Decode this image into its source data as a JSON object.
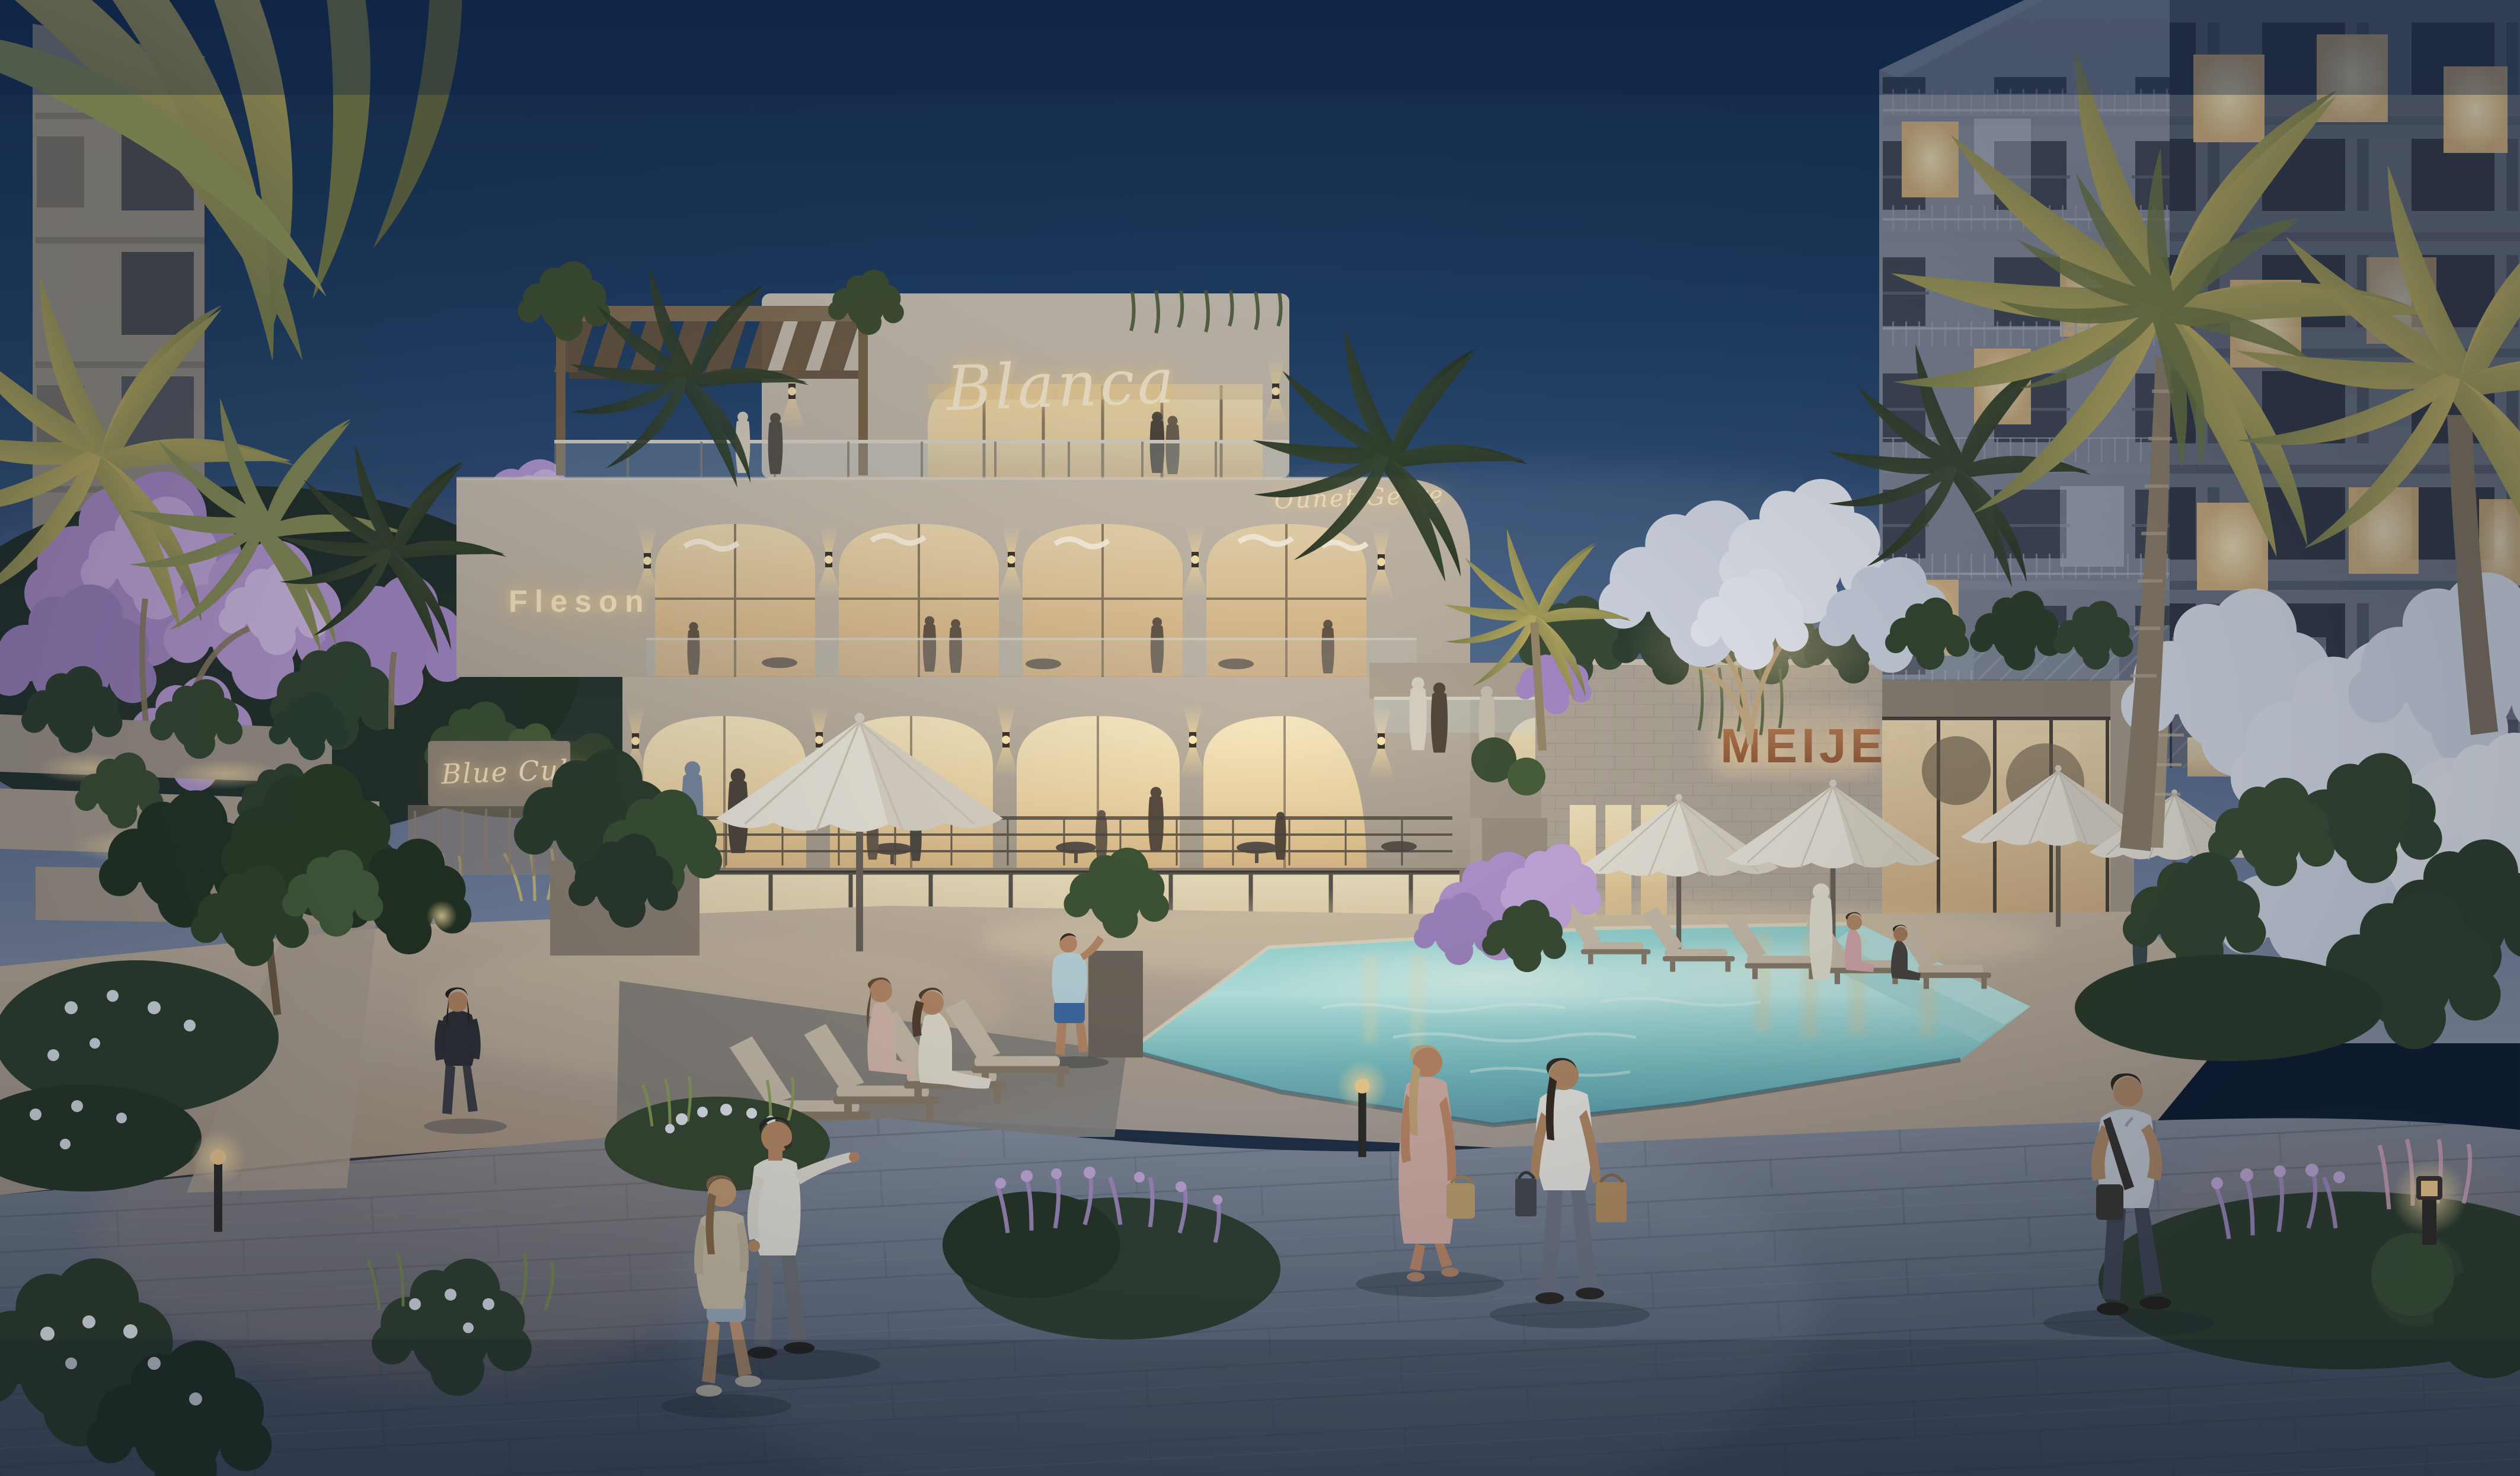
{
  "meta": {
    "description": "Dusk architectural rendering of a luxury residential resort: three-tier restaurant building, lit swimming pool courtyard, residential tower, palms, flowering trees and people strolling a stone plaza"
  },
  "signs": {
    "blanca": "Blanca",
    "fleson": "Fleson",
    "terrace_script": "Ounet Gerre",
    "blue_club": "Blue Cule",
    "meijer": "MEIJER"
  },
  "palette": {
    "sky_top": "#14325b",
    "sky_horizon": "#8a93a8",
    "facade_light": "#cfc5b5",
    "warm_window": "#f2dcae",
    "neon": "#ffeccb",
    "meijer_copper": "#a86b45",
    "pool_water": "#9fd9d6",
    "plaza_stone": "#5c6678",
    "foliage_dark": "#2d4231",
    "lilac": "#b99bd6"
  }
}
